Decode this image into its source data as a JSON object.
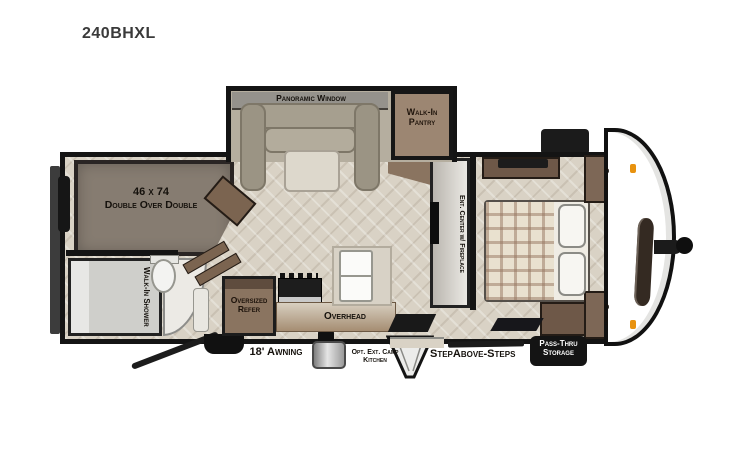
{
  "header": {
    "model": "240BHXL"
  },
  "floorplan": {
    "slide_out": {
      "window_label": "Panoramic Window"
    },
    "pantry": {
      "label": "Walk-In Pantry"
    },
    "bunk": {
      "size": "46 x 74",
      "label": "Double Over Double"
    },
    "bathroom": {
      "shower_label": "Walk-In Shower"
    },
    "kitchen": {
      "refrigerator_label": "Oversized Refer",
      "overhead_label": "Overhead"
    },
    "entertainment": {
      "label": "Ent. Center w/ Fireplace"
    },
    "bedroom": {
      "closet_front_top": "Closet",
      "closet_front_bottom": "Closet"
    },
    "exterior": {
      "awning_label": "18' Awning",
      "camp_kitchen_label": "Opt. Ext. Camp Kitchen",
      "steps_label": "StepAbove-Steps",
      "storage_label": "Pass-Thru Storage"
    }
  },
  "colors": {
    "wall": "#141414",
    "floor": "#d9d2c5",
    "wood": "#8a7460",
    "wood_dark": "#6e5848",
    "bunk": "#867c71",
    "sofa": "#a69f8f",
    "counter": "#d8d2c6",
    "shower": "#cfcfcb",
    "plaid_base": "#e9e1cf",
    "plaid_stripe": "#9b8574",
    "label_ink": "#15110c",
    "marker_orange": "#e8920f",
    "storage_tag_bg": "#141414",
    "storage_tag_text": "#ffffff"
  }
}
